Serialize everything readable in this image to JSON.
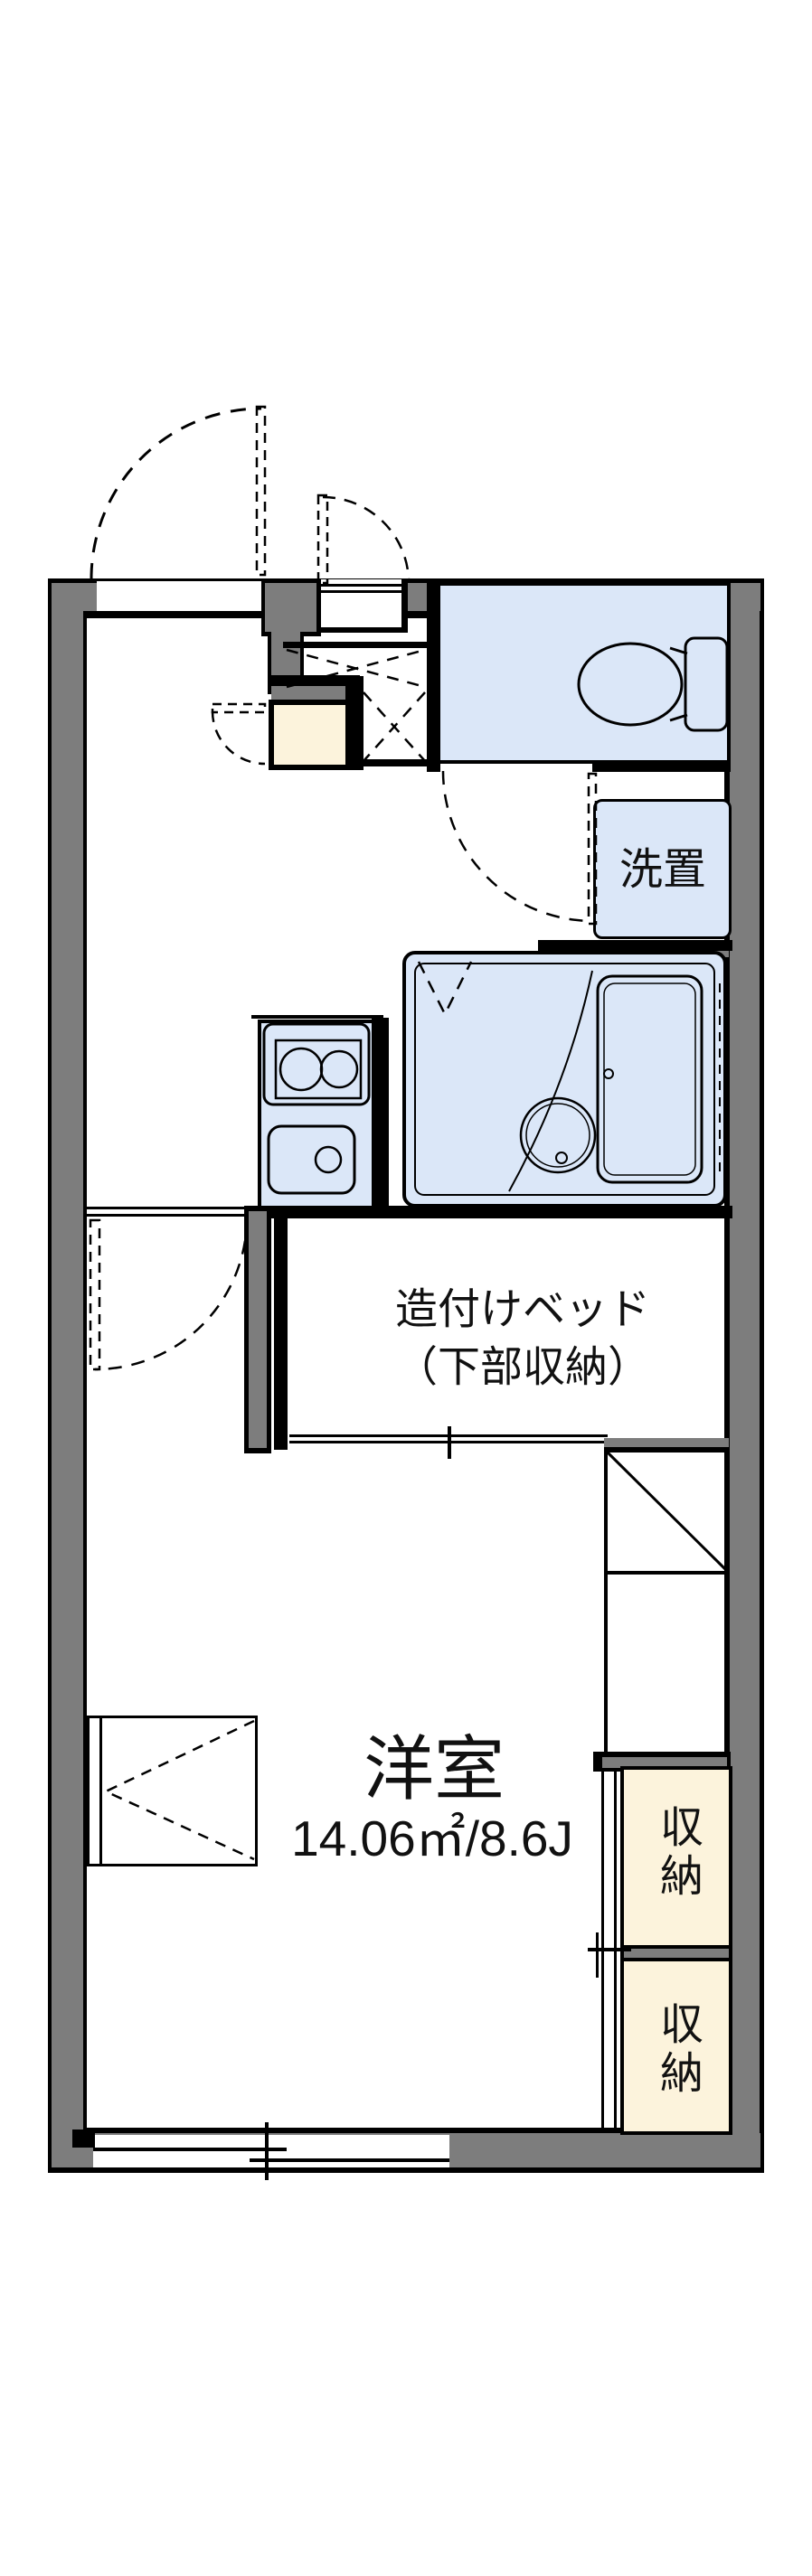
{
  "plan": {
    "type": "apartment-floor-plan",
    "room_name": "洋室",
    "room_area": "14.06㎡/8.6J",
    "bed_label_line1": "造付けベッド",
    "bed_label_line2": "（下部収納）",
    "washer_label": "洗置",
    "storage_upper_label": "収納",
    "storage_lower_label": "収納"
  },
  "colors": {
    "wall_gray": "#7d7d7d",
    "wet_area_blue": "#dbe7f8",
    "storage_cream": "#fcf3dc",
    "line_black": "#000000",
    "background": "#ffffff"
  }
}
